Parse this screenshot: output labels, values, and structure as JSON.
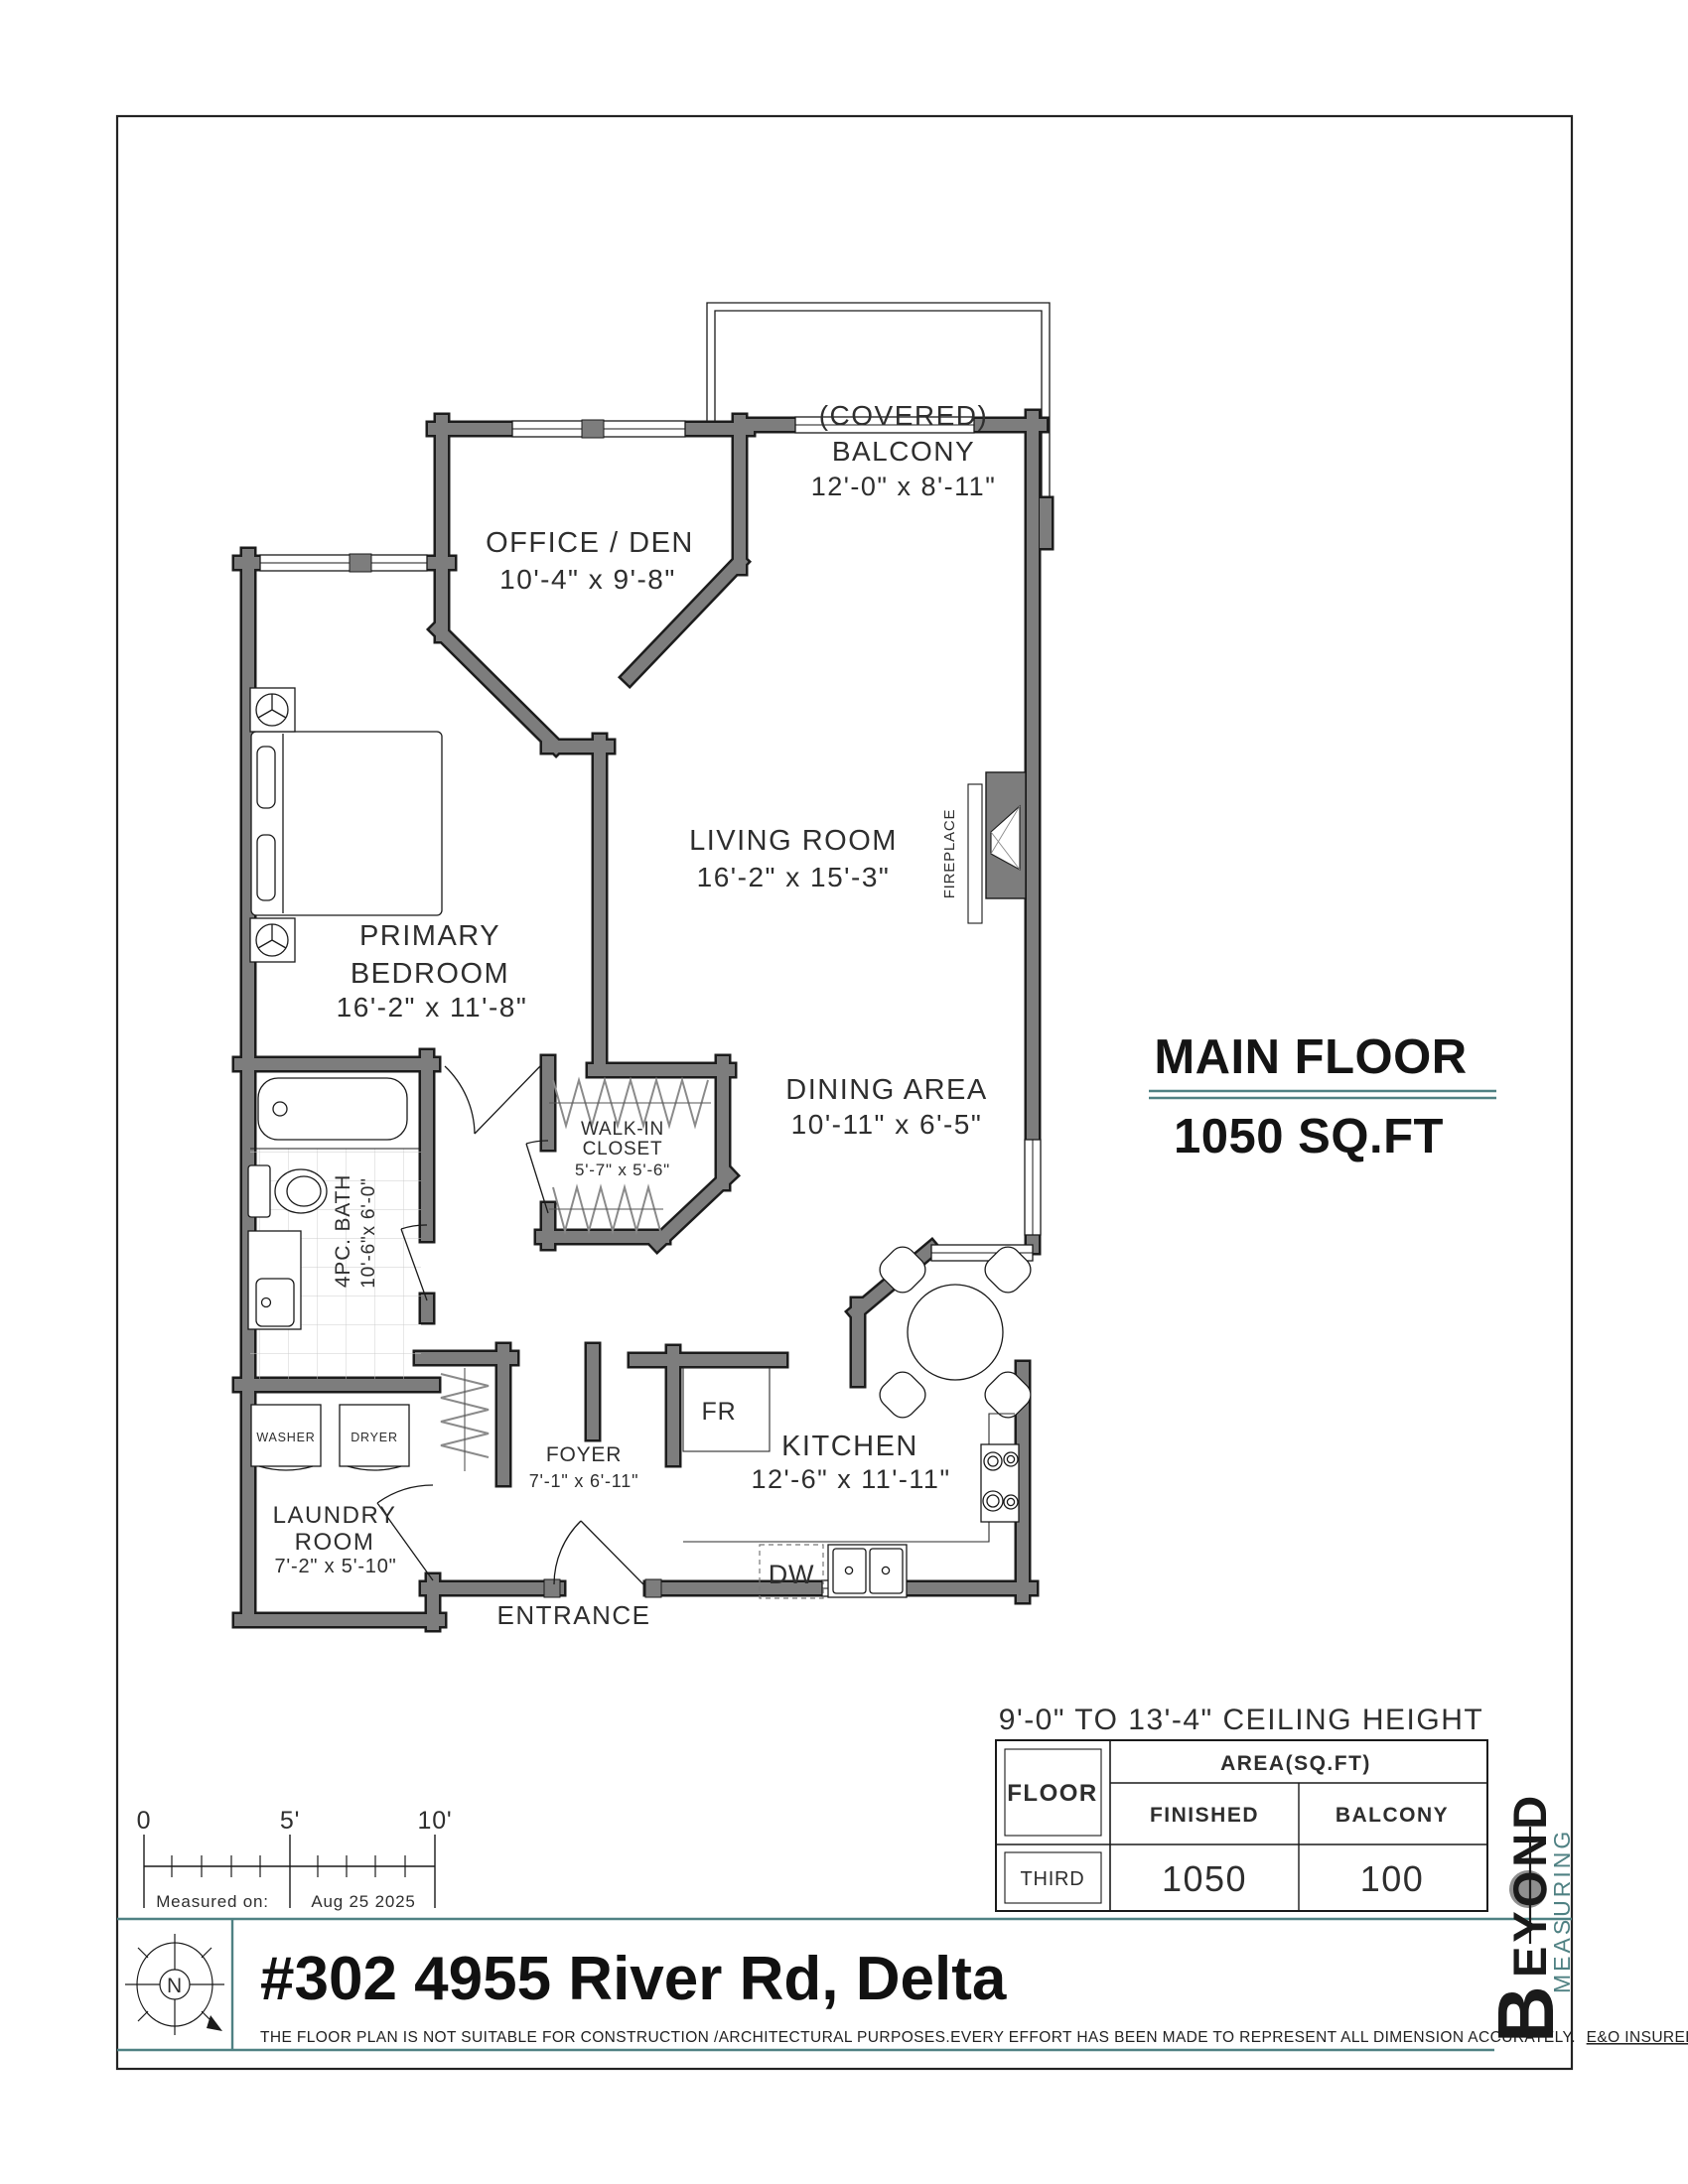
{
  "page": {
    "title": "#302 4955 River Rd, Delta",
    "disclaimer": "THE  FLOOR PLAN  IS NOT SUITABLE FOR CONSTRUCTION /ARCHITECTURAL PURPOSES.EVERY EFFORT HAS BEEN MADE TO REPRESENT ALL DIMENSION ACCURATELY.",
    "disclaimer_suffix": "E&O INSURED.",
    "compass_letter": "N"
  },
  "summary": {
    "floor_label": "MAIN FLOOR",
    "area_label": "1050 SQ.FT",
    "ceiling_note": "9'-0\" TO 13'-4\" CEILING HEIGHT"
  },
  "rooms": {
    "balcony": {
      "name1": "(COVERED)",
      "name2": "BALCONY",
      "dims": "12'-0\" x 8'-11\""
    },
    "office": {
      "name": "OFFICE / DEN",
      "dims": "10'-4\" x 9'-8\""
    },
    "living": {
      "name": "LIVING ROOM",
      "dims": "16'-2\" x 15'-3\""
    },
    "bedroom": {
      "name1": "PRIMARY",
      "name2": "BEDROOM",
      "dims": "16'-2\" x 11'-8\""
    },
    "closet": {
      "name1": "WALK-IN",
      "name2": "CLOSET",
      "dims": "5'-7\" x 5'-6\""
    },
    "dining": {
      "name": "DINING AREA",
      "dims": "10'-11\" x 6'-5\""
    },
    "bath": {
      "name": "4PC. BATH",
      "dims": "10'-6\"x 6'-0\""
    },
    "laundry": {
      "name1": "LAUNDRY",
      "name2": "ROOM",
      "dims": "7'-2\" x 5'-10\""
    },
    "foyer": {
      "name": "FOYER",
      "dims": "7'-1\" x 6'-11\""
    },
    "kitchen": {
      "name": "KITCHEN",
      "dims": "12'-6\" x 11'-11\""
    },
    "entrance": {
      "name": "ENTRANCE"
    },
    "fireplace": {
      "name": "FIREPLACE"
    }
  },
  "fixtures": {
    "washer": "WASHER",
    "dryer": "DRYER",
    "fridge": "FR",
    "dishwasher": "DW"
  },
  "area_table": {
    "floor_header": "FLOOR",
    "area_header": "AREA(SQ.FT)",
    "col_finished": "FINISHED",
    "col_balcony": "BALCONY",
    "row_label": "THIRD",
    "finished_value": "1050",
    "balcony_value": "100"
  },
  "scale_bar": {
    "tick0": "0",
    "tick5": "5'",
    "tick10": "10'",
    "measured_label": "Measured on:",
    "measured_date": "Aug 25 2025"
  },
  "logo": {
    "word1_initial": "B",
    "word1_rest": "EYOND",
    "word2": "MEASURING"
  },
  "colors": {
    "teal": "#4f8183",
    "wall_gray": "#7d7d7d",
    "logo_gray": "#8f8f8f"
  }
}
